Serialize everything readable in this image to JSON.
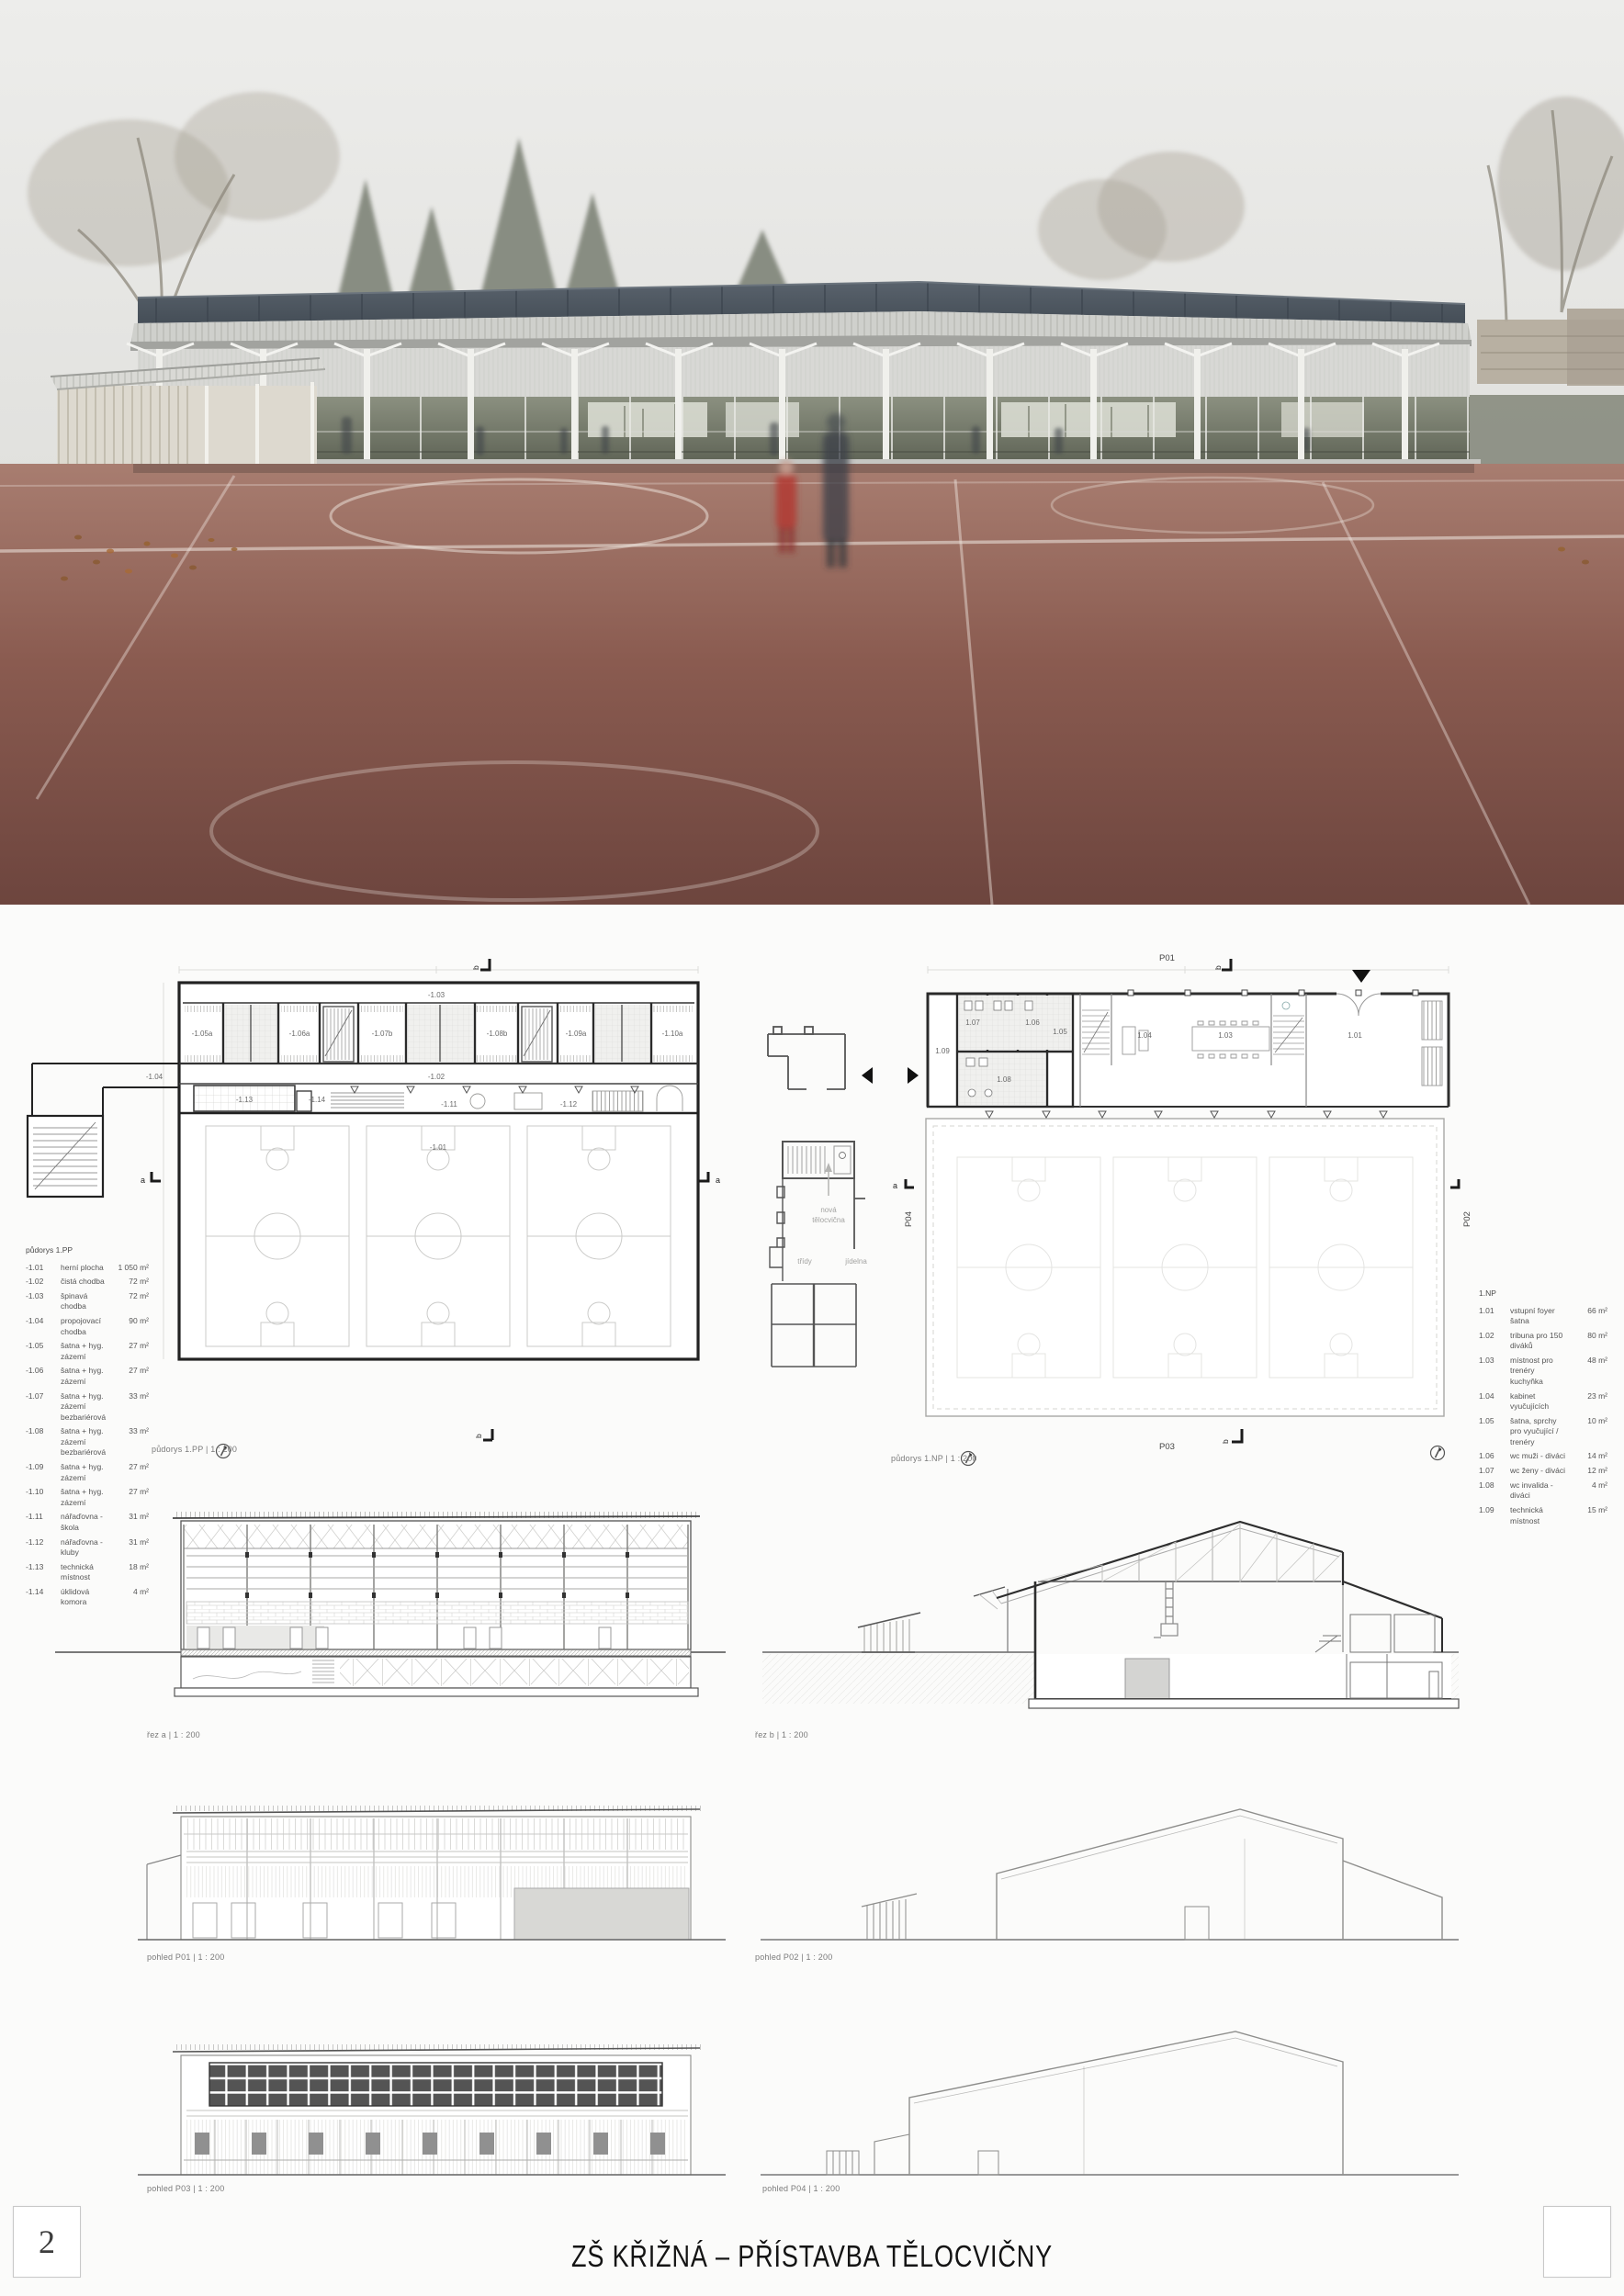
{
  "page": {
    "number": "2",
    "title": "ZŠ KŘIŽNÁ – PŘÍSTAVBA TĚLOCVIČNY"
  },
  "colors": {
    "track": "#7d4f45",
    "solar_roof": "#4d565f",
    "facade": "#d8d8d5",
    "wall_line": "#1f1f1f"
  },
  "plan_pp": {
    "caption": "půdorys 1.PP | 1 : 200",
    "legend_title": "půdorys 1.PP",
    "legend": [
      {
        "id": "-1.01",
        "name": "herní plocha",
        "area": "1 050 m²"
      },
      {
        "id": "-1.02",
        "name": "čistá chodba",
        "area": "72 m²"
      },
      {
        "id": "-1.03",
        "name": "špinavá chodba",
        "area": "72 m²"
      },
      {
        "id": "-1.04",
        "name": "propojovací chodba",
        "area": "90 m²"
      },
      {
        "id": "-1.05",
        "name": "šatna + hyg. zázemí",
        "area": "27 m²"
      },
      {
        "id": "-1.06",
        "name": "šatna + hyg. zázemí",
        "area": "27 m²"
      },
      {
        "id": "-1.07",
        "name": "šatna + hyg. zázemí\nbezbariérová",
        "area": "33 m²"
      },
      {
        "id": "-1.08",
        "name": "šatna + hyg. zázemí\nbezbariérová",
        "area": "33 m²"
      },
      {
        "id": "-1.09",
        "name": "šatna + hyg. zázemí",
        "area": "27 m²"
      },
      {
        "id": "-1.10",
        "name": "šatna + hyg. zázemí",
        "area": "27 m²"
      },
      {
        "id": "-1.11",
        "name": "nářaďovna - škola",
        "area": "31 m²"
      },
      {
        "id": "-1.12",
        "name": "nářaďovna - kluby",
        "area": "31 m²"
      },
      {
        "id": "-1.13",
        "name": "technická místnost",
        "area": "18 m²"
      },
      {
        "id": "-1.14",
        "name": "úklidová komora",
        "area": "4 m²"
      }
    ],
    "room_labels": {
      "r03": "-1.03",
      "r05a": "-1.05a",
      "r06a": "-1.06a",
      "r07b": "-1.07b",
      "r08b": "-1.08b",
      "r09a": "-1.09a",
      "r10a": "-1.10a",
      "r02": "-1.02",
      "r04": "-1.04",
      "r13": "-1.13",
      "r14": "-1.14",
      "r11": "-1.11",
      "r12": "-1.12",
      "r01": "-1.01"
    }
  },
  "plan_np": {
    "caption": "půdorys 1.NP | 1 : 200",
    "legend_title": "1.NP",
    "legend": [
      {
        "id": "1.01",
        "name": "vstupní foyer\nšatna",
        "area": "66 m²"
      },
      {
        "id": "1.02",
        "name": "tribuna pro 150 diváků",
        "area": "80 m²"
      },
      {
        "id": "1.03",
        "name": "místnost pro trenéry\nkuchyňka",
        "area": "48 m²"
      },
      {
        "id": "1.04",
        "name": "kabinet vyučujících",
        "area": "23 m²"
      },
      {
        "id": "1.05",
        "name": "šatna, sprchy\npro vyučující / trenéry",
        "area": "10 m²"
      },
      {
        "id": "1.06",
        "name": "wc muži - diváci",
        "area": "14 m²"
      },
      {
        "id": "1.07",
        "name": "wc ženy - diváci",
        "area": "12 m²"
      },
      {
        "id": "1.08",
        "name": "wc invalida - diváci",
        "area": "4 m²"
      },
      {
        "id": "1.09",
        "name": "technická místnost",
        "area": "15 m²"
      }
    ],
    "room_labels": {
      "r09": "1.09",
      "r07": "1.07",
      "r06": "1.06",
      "r05": "1.05",
      "r08": "1.08",
      "r04": "1.04",
      "r03": "1.03",
      "r01": "1.01"
    }
  },
  "context_plan": {
    "labels": {
      "new_gym_line1": "nová",
      "new_gym_line2": "tělocvična",
      "classes": "třídy",
      "canteen": "jídelna"
    }
  },
  "markers": {
    "p01": "P01",
    "p02": "P02",
    "p03": "P03",
    "p04": "P04",
    "sec_a": "a",
    "sec_b": "b"
  },
  "sections": {
    "a": "řez a | 1 : 200",
    "b": "řez b | 1 : 200"
  },
  "elevations": {
    "p01": "pohled P01 | 1 : 200",
    "p02": "pohled P02 | 1 : 200",
    "p03": "pohled P03 | 1 : 200",
    "p04": "pohled P04 | 1 : 200"
  }
}
